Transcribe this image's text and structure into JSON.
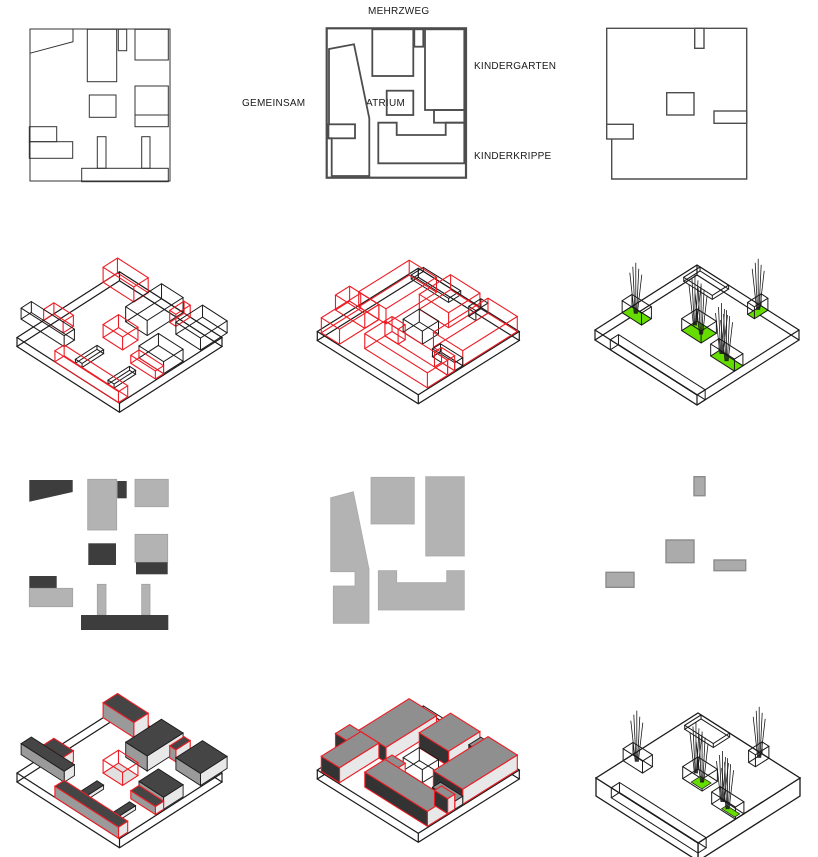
{
  "labels": {
    "mehrzweg": "MEHRZWEG",
    "kindergarten": "KINDERGARTEN",
    "gemeinsam": "GEMEINSAM",
    "atrium": "ATRIUM",
    "kinderkrippe": "KINDERKRIPPE"
  },
  "colors": {
    "background": "#ffffff",
    "line": "#1a1a1a",
    "red": "#ed1c24",
    "green": "#66dd00",
    "plan_stroke": "#4d4d4d",
    "plan_thin_stroke": "#333333",
    "light_gray": "#b3b3b3",
    "dark_gray": "#3d3d3d",
    "mid_gray_border": "#8c8c8c",
    "box_top_dark": "#454545",
    "box_top_mid": "#8f8f8f",
    "face_light": "#e8e8e8",
    "face_shadow": "#9a9a9a",
    "face_dark": "#333333",
    "floor_pale": "#e0e0e0"
  }
}
